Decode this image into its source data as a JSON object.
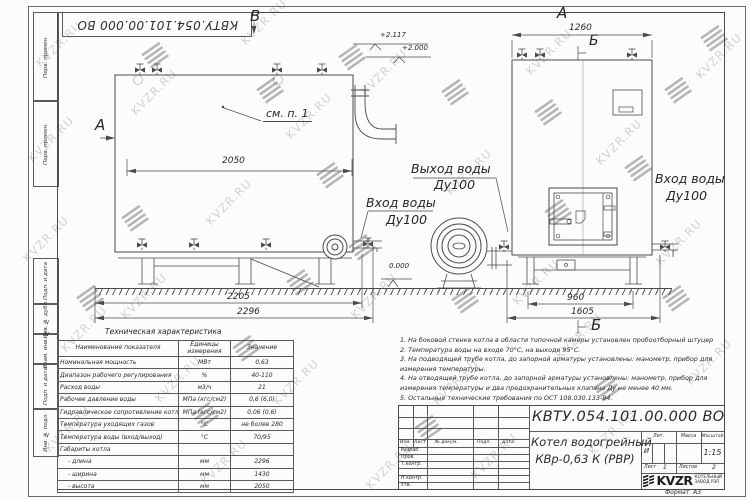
{
  "doc_number": "КВТУ.054.101.00.000  ВО",
  "watermark": {
    "text": "KVZR.RU"
  },
  "frame_fields": [
    "Перв. примен.",
    "Перв. примен.",
    "Подп. и дата",
    "Инв. № дубл.",
    "Взам. инв. №",
    "Подп. и дата",
    "Инв. № подл."
  ],
  "drawing": {
    "view_labels": {
      "a_left": "А",
      "a_right": "А",
      "b_top": "Б",
      "b_bottom": "Б",
      "v_top": "В"
    },
    "callout_see_item": "см. п. 1",
    "water_outlet": {
      "line1": "Выход воды",
      "line2": "Ду100"
    },
    "water_inlet_left": {
      "line1": "Вход воды",
      "line2": "Ду100"
    },
    "water_inlet_right": {
      "line1": "Вход воды",
      "line2": "Ду100"
    },
    "elevations": {
      "stack_top": "+2.117",
      "outlet_top": "+2.000",
      "ground": "0.000"
    },
    "dimensions": {
      "body_length": "2050",
      "frame_length": "2205",
      "overall_length": "2296",
      "front_width": "1260",
      "frame_width": "960",
      "overall_width": "1605"
    }
  },
  "spec_table": {
    "title": "Техническая характеристика",
    "col_name": "Наименование показателя",
    "col_units": "Единицы измерения",
    "col_value": "Значение",
    "rows": [
      {
        "name": "Номинальная мощность",
        "units": "МВт",
        "value": "0,63"
      },
      {
        "name": "Диапазон рабочего регулирования",
        "units": "%",
        "value": "40-110"
      },
      {
        "name": "Расход воды",
        "units": "м3/ч",
        "value": "21"
      },
      {
        "name": "Рабочее давление воды",
        "units": "МПа (кгс/см2)",
        "value": "0,6 (6,0)"
      },
      {
        "name": "Гидравлическое сопротивление котла",
        "units": "МПа (кгс/см2)",
        "value": "0,06 (0,6)"
      },
      {
        "name": "Температура уходящих газов",
        "units": "°С",
        "value": "не более 280"
      },
      {
        "name": "Температура воды (вход/выход)",
        "units": "°С",
        "value": "70/95"
      },
      {
        "name": "Габариты котла",
        "units": "",
        "value": ""
      },
      {
        "name": "- длина",
        "units": "мм",
        "value": "2296"
      },
      {
        "name": "- ширина",
        "units": "мм",
        "value": "1430"
      },
      {
        "name": "- высота",
        "units": "мм",
        "value": "2050"
      }
    ]
  },
  "notes": [
    "1.  На боковой стенке котла в области топочной камеры установлен пробоотборный штуцер",
    "2.  Температура воды на входе 70°С, на выходе 95°С.",
    "3.  На подводящей трубе котла, до запорной арматуры установлены: манометр, прибор для измерения температуры.",
    "4.  На отводящей трубе котла, до запорной арматуры установлены: манометр, прибор для измерения температуры и два предохранительных клапана Ду не менее 40 мм.",
    "5.  Остальные технические требования по ОСТ 108.030.133-84."
  ],
  "title_block": {
    "col_izm": "Изм.",
    "col_list": "Лист",
    "col_doc": "№ докум.",
    "col_sign": "Подп.",
    "col_date": "Дата",
    "roles": [
      "Разраб.",
      "Пров.",
      "Т.контр.",
      "Н.контр.",
      "Утв."
    ],
    "product_line1": "Котел водогрейный",
    "product_line2": "КВр-0,63 К (РВР)",
    "lit_label": "Лит.",
    "lit_value": "И",
    "mass_label": "Масса",
    "scale_label": "Масштаб",
    "scale_value": "1:15",
    "sheet_label": "Лист",
    "sheet_value": "1",
    "sheets_label": "Листов",
    "sheets_value": "2",
    "logo_text": "KVZR",
    "logo_sub1": "КОТЕЛЬНЫЙ",
    "logo_sub2": "ЗАВОД РЭП",
    "format_label": "Формат",
    "format_value": "А3"
  }
}
